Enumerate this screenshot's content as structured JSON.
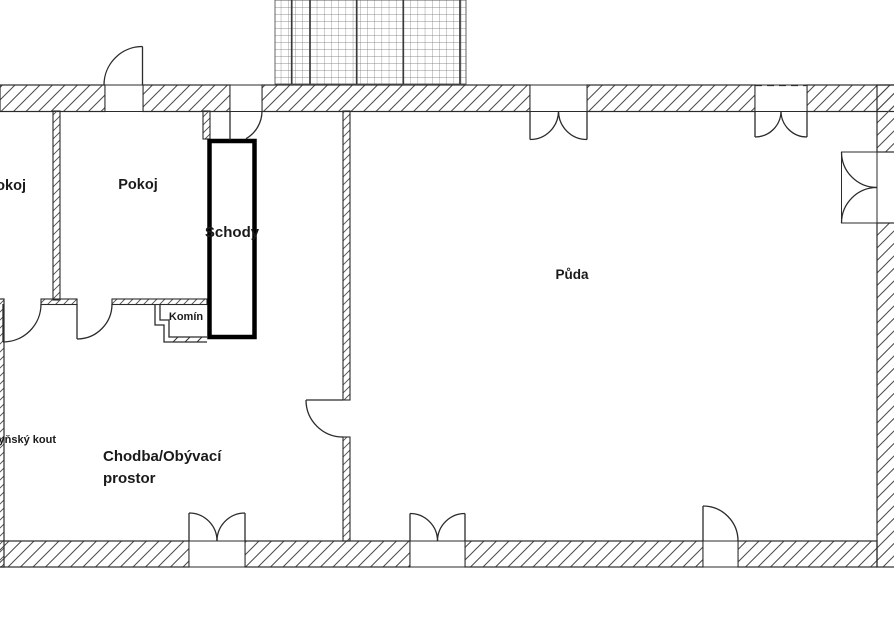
{
  "labels": {
    "room_left": "Pokoj",
    "room_center": "Pokoj",
    "stairs": "Schody",
    "chimney": "Komín",
    "attic": "Půda",
    "kitchen_corner": "Kuchyňský kout",
    "hall_line1": "Chodba/Obývací",
    "hall_line2": "prostor"
  },
  "colors": {
    "background": "#ffffff",
    "wall_line": "#2b2b2b",
    "hatch_line": "#4a4a4a",
    "stairs_outline": "#000000",
    "text": "#1a1a1a"
  }
}
